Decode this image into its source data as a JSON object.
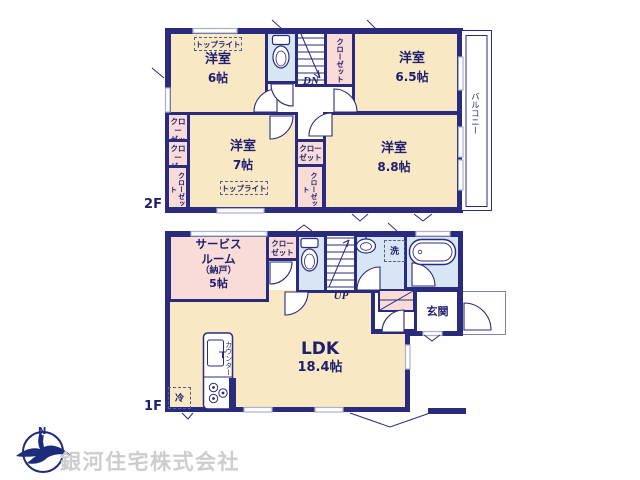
{
  "colors": {
    "wall": "#2b2b7e",
    "room_tan": "#f8e8c4",
    "room_pink": "#f9dcd8",
    "room_wet_blue": "#d8e5f4",
    "window_gray": "#a9b2cd",
    "label_navy": "#1e1e6e",
    "company_gray": "#cdcdcd",
    "logo_navy": "#1d2b7b"
  },
  "floor2": {
    "label": "2F",
    "bedroom_nw": {
      "name": "洋室",
      "size": "6帖"
    },
    "bedroom_ne": {
      "name": "洋室",
      "size": "6.5帖"
    },
    "bedroom_sw": {
      "name": "洋室",
      "size": "7帖"
    },
    "bedroom_se": {
      "name": "洋室",
      "size": "8.8帖"
    },
    "balcony": "バルコニー",
    "stairs_label": "DN",
    "skylight": "トップライト",
    "closet": "クローゼット",
    "closet_l1": "クロー",
    "closet_l2": "ゼット"
  },
  "floor1": {
    "label": "1F",
    "service_room": {
      "line1": "サービス",
      "line2": "ルーム",
      "line3": "（納戸）",
      "size": "5帖"
    },
    "ldk": {
      "name": "LDK",
      "size": "18.4帖"
    },
    "entrance": "玄関",
    "stairs_label": "UP",
    "closet_l1": "クロー",
    "closet_l2": "ゼット",
    "laundry": "洗",
    "fridge": "冷",
    "counter": "カウンター"
  },
  "company": {
    "name": "銀河住宅株式会社",
    "logo_letter": "N"
  }
}
